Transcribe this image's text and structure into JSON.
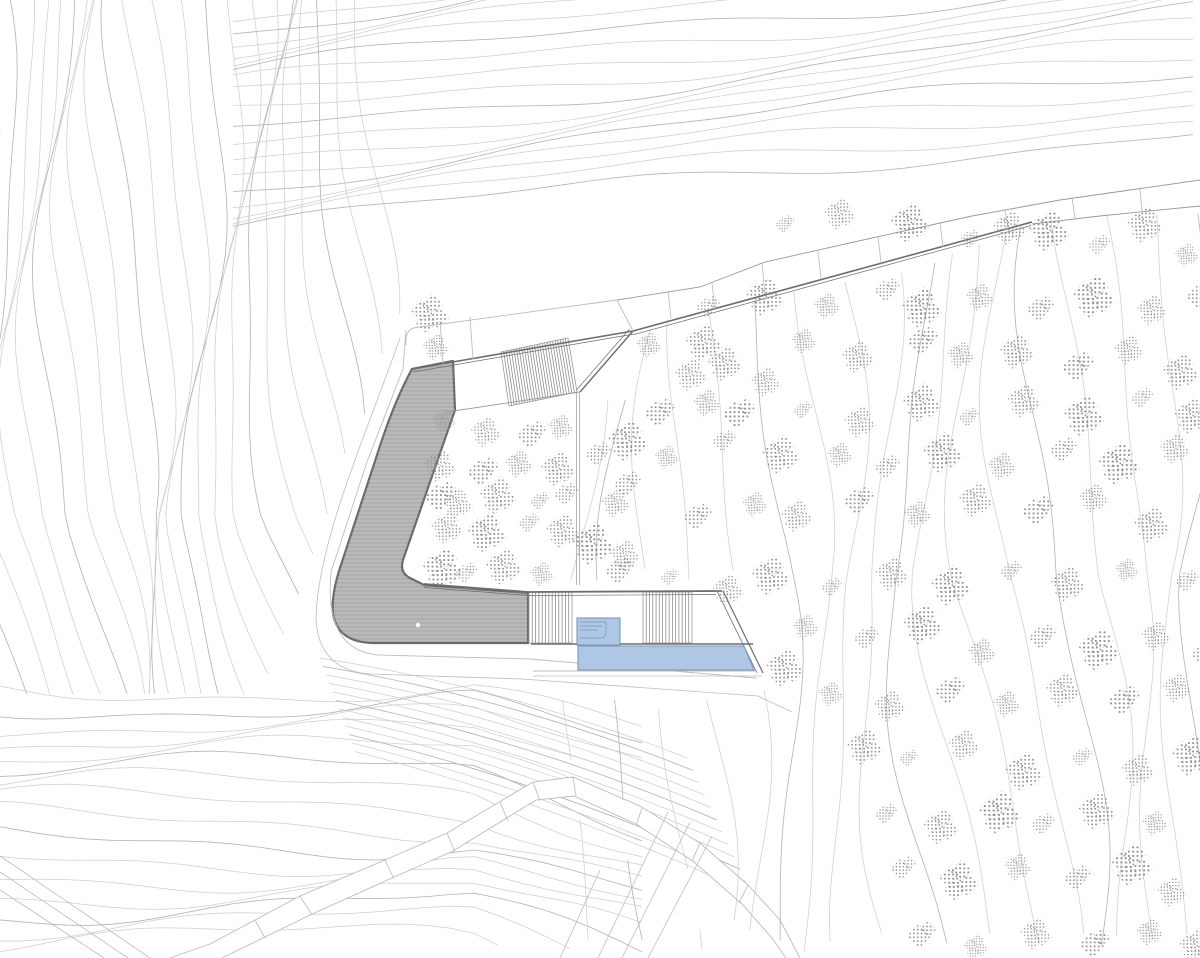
{
  "colors": {
    "paper": "#ffffff",
    "contour": "#cfcfcf",
    "contour_dark": "#b5b5b5",
    "outline": "#6d6d6d",
    "outline_mid": "#9a9a9a",
    "outline_soft": "#bcbcbc",
    "roof": "#b3b3b3",
    "roof_edge": "#6a6a6a",
    "stair_line": "#8f8f8f",
    "tree_dot": "#8f8f8f",
    "pool_fill": "#adc7e4",
    "pool_edge": "#7d97b5"
  },
  "site": {
    "contour_fields": {
      "left": 24,
      "top": 18,
      "right": 18,
      "bottom": 16,
      "bundle": 12
    },
    "white_shapes": [
      "M413,328 L617,300 L633,331 L412,369 Z",
      "M617,300 L700,287 L765,262 L872,238 L972,216 L1060,200 L1130,190 L1200,180 L1200,206 L1100,216 L1032,224 L957,243 L845,272 L735,302 L633,331 Z",
      "M452,412 L578,392 L578,586 L424,584 Q404,581 403,559 Z",
      "M528,591 L723,591 L765,677 L530,677 Z",
      "M170,958 L210,944 L300,896 L385,860 L447,833 L533,782 L573,777 L640,806 L700,843 L748,885 L780,920 L800,958 L786,958 L772,938 L742,904 L694,862 L636,824 L574,796 L536,800 L453,851 L392,878 L310,915 L222,958 Z"
    ],
    "roof_path": "M412,369 L453,361 L455,410 L404,557 Q398,572 410,578 L424,585 L528,593 L528,643 L375,643 Q338,643 333,614 Q331,596 340,568 L378,452 Q394,402 412,369 Z",
    "roof_drain": [
      418,
      625
    ],
    "linework": [
      {
        "d": "M413,328 L617,300",
        "c": "soft",
        "w": 0.9
      },
      {
        "d": "M406,345 Q405,330 414,328",
        "c": "soft",
        "w": 0.9
      },
      {
        "d": "M406,330 L403,369 L367,462 L331,572 Q324,650 378,655 L530,659 L756,678",
        "c": "soft",
        "w": 0.9
      },
      {
        "d": "M400,338 C368,430 318,540 316,618 Q318,670 370,674 L522,679 L758,696 L792,712",
        "c": "soft",
        "w": 0.8
      },
      {
        "d": "M412,369 L633,331",
        "c": "dark",
        "w": 1.6
      },
      {
        "d": "M413,372 L634,334",
        "c": "dark",
        "w": 0.7
      },
      {
        "d": "M633,331 L1032,222",
        "c": "dark",
        "w": 1.6
      },
      {
        "d": "M634,334.5 L1031,225.5",
        "c": "dark",
        "w": 0.7
      },
      {
        "d": "M633,331 L580,392",
        "c": "dark",
        "w": 1.4
      },
      {
        "d": "M629.5,329 L576.5,390",
        "c": "dark",
        "w": 0.7
      },
      {
        "d": "M447,412 L580,392",
        "c": "mid",
        "w": 0.9
      },
      {
        "d": "M576.5,393 L576.5,585",
        "c": "mid",
        "w": 0.7
      },
      {
        "d": "M579.5,393 L579.5,585",
        "c": "mid",
        "w": 0.7
      },
      {
        "d": "M424,584 L528,592 L722,591",
        "c": "dark",
        "w": 1.8
      },
      {
        "d": "M424,587.5 L528,595.5 L716,594.5",
        "c": "dark",
        "w": 0.7
      },
      {
        "d": "M723,591 L763,673",
        "c": "dark",
        "w": 1.2
      },
      {
        "d": "M717,591 L757,673",
        "c": "dark",
        "w": 0.8
      },
      {
        "d": "M531,644 L753,644",
        "c": "dark",
        "w": 1.6
      },
      {
        "d": "M533,671 L757,671",
        "c": "soft",
        "w": 0.9
      },
      {
        "d": "M533,676 L762,676",
        "c": "soft",
        "w": 0.8
      },
      {
        "d": "M617,300 L700,287 L765,262 L872,238 L972,216 L1060,200 L1130,190 L1200,180",
        "c": "mid",
        "w": 0.9
      },
      {
        "d": "M1032,224 L1100,216 L1200,206",
        "c": "mid",
        "w": 0.9
      },
      {
        "d": "M170,958 L210,944 L300,896 L385,860 L447,833 L533,782 L573,777 L640,806 L700,843 L748,885 L780,920 L800,958",
        "c": "soft",
        "w": 0.9
      },
      {
        "d": "M222,958 L310,915 L392,878 L453,851 L536,800 L574,796 L636,824 L694,862 L742,904 L772,938 L786,958",
        "c": "soft",
        "w": 0.9
      },
      {
        "d": "M598,958 L668,812",
        "c": "soft",
        "w": 0.8
      },
      {
        "d": "M622,958 L690,822",
        "c": "soft",
        "w": 0.8
      },
      {
        "d": "M648,958 L712,836",
        "c": "soft",
        "w": 0.8
      },
      {
        "d": "M560,958 L600,870",
        "c": "soft",
        "w": 0.8
      },
      {
        "d": "M0,856 L150,958",
        "c": "soft",
        "w": 0.8
      },
      {
        "d": "M0,872 L128,958",
        "c": "soft",
        "w": 0.8
      },
      {
        "d": "M0,890 L104,958",
        "c": "soft",
        "w": 0.8
      }
    ],
    "divisions": [
      [
        440,
        321,
        443,
        364
      ],
      [
        470,
        317,
        473,
        359
      ],
      [
        617,
        300,
        633,
        331
      ],
      [
        668,
        291,
        671,
        318
      ],
      [
        712,
        283,
        715,
        309
      ],
      [
        762,
        263,
        765,
        294
      ],
      [
        818,
        251,
        821,
        279
      ],
      [
        878,
        236,
        881,
        263
      ],
      [
        940,
        222,
        943,
        247
      ],
      [
        1005,
        209,
        1008,
        230
      ],
      [
        1072,
        197,
        1075,
        219
      ],
      [
        1140,
        189,
        1142,
        212
      ],
      [
        300,
        896,
        312,
        915
      ],
      [
        385,
        860,
        394,
        879
      ],
      [
        447,
        833,
        455,
        852
      ],
      [
        500,
        802,
        508,
        821
      ],
      [
        533,
        782,
        540,
        801
      ],
      [
        573,
        777,
        576,
        796
      ],
      [
        642,
        808,
        636,
        826
      ],
      [
        700,
        843,
        692,
        861
      ],
      [
        748,
        885,
        739,
        903
      ],
      [
        255,
        920,
        265,
        938
      ]
    ],
    "stairs": [
      {
        "corners": [
          [
            501,
            352
          ],
          [
            568,
            338
          ],
          [
            577,
            392
          ],
          [
            509,
            406
          ]
        ],
        "treads": 26
      },
      {
        "corners": [
          [
            529,
            592
          ],
          [
            572,
            592
          ],
          [
            572,
            643
          ],
          [
            529,
            643
          ]
        ],
        "treads": 13
      },
      {
        "corners": [
          [
            643,
            592
          ],
          [
            692,
            592
          ],
          [
            692,
            643
          ],
          [
            643,
            643
          ]
        ],
        "treads": 15
      }
    ],
    "pool": {
      "body": [
        [
          578,
          646
        ],
        [
          744,
          646
        ],
        [
          754,
          670
        ],
        [
          578,
          670
        ]
      ],
      "spa": [
        577,
        618,
        43,
        27
      ],
      "spa_steps": "M580,622 H606 M580,626 H602 M580,630 H598 M606,622 V632 Q606,638 600,638 H580"
    },
    "trees": [
      [
        452,
        428
      ],
      [
        492,
        425
      ],
      [
        533,
        430
      ],
      [
        563,
        422
      ],
      [
        440,
        462
      ],
      [
        478,
        470
      ],
      [
        515,
        462
      ],
      [
        552,
        468
      ],
      [
        430,
        498
      ],
      [
        465,
        505
      ],
      [
        503,
        498
      ],
      [
        541,
        505
      ],
      [
        448,
        532
      ],
      [
        486,
        538
      ],
      [
        524,
        530
      ],
      [
        558,
        538
      ],
      [
        436,
        562
      ],
      [
        472,
        568
      ],
      [
        510,
        562
      ],
      [
        546,
        570
      ],
      [
        566,
        492
      ],
      [
        430,
        312
      ],
      [
        434,
        346
      ],
      [
        592,
        455
      ],
      [
        622,
        442
      ],
      [
        608,
        505
      ],
      [
        632,
        488
      ],
      [
        598,
        548
      ],
      [
        628,
        560
      ],
      [
        618,
        578
      ],
      [
        648,
        352
      ],
      [
        688,
        368
      ],
      [
        652,
        408
      ],
      [
        700,
        398
      ],
      [
        733,
        360
      ],
      [
        742,
        412
      ],
      [
        770,
        380
      ],
      [
        706,
        342
      ],
      [
        783,
        225
      ],
      [
        838,
        215
      ],
      [
        906,
        225
      ],
      [
        962,
        243
      ],
      [
        1002,
        232
      ],
      [
        1056,
        236
      ],
      [
        1102,
        252
      ],
      [
        1148,
        232
      ],
      [
        1188,
        248
      ],
      [
        705,
        302
      ],
      [
        762,
        292
      ],
      [
        822,
        302
      ],
      [
        878,
        288
      ],
      [
        930,
        306
      ],
      [
        986,
        296
      ],
      [
        1042,
        310
      ],
      [
        1096,
        298
      ],
      [
        1152,
        312
      ],
      [
        1196,
        300
      ],
      [
        800,
        345
      ],
      [
        852,
        362
      ],
      [
        912,
        348
      ],
      [
        968,
        362
      ],
      [
        1022,
        345
      ],
      [
        1078,
        362
      ],
      [
        1130,
        345
      ],
      [
        1180,
        368
      ],
      [
        798,
        408
      ],
      [
        855,
        420
      ],
      [
        915,
        402
      ],
      [
        975,
        418
      ],
      [
        1030,
        402
      ],
      [
        1088,
        418
      ],
      [
        1142,
        402
      ],
      [
        1192,
        420
      ],
      [
        665,
        462
      ],
      [
        718,
        448
      ],
      [
        775,
        462
      ],
      [
        832,
        448
      ],
      [
        892,
        462
      ],
      [
        948,
        448
      ],
      [
        1005,
        462
      ],
      [
        1062,
        448
      ],
      [
        1118,
        462
      ],
      [
        1172,
        448
      ],
      [
        690,
        518
      ],
      [
        748,
        505
      ],
      [
        805,
        518
      ],
      [
        862,
        505
      ],
      [
        922,
        518
      ],
      [
        978,
        505
      ],
      [
        1035,
        518
      ],
      [
        1092,
        505
      ],
      [
        1148,
        518
      ],
      [
        662,
        572
      ],
      [
        720,
        585
      ],
      [
        778,
        572
      ],
      [
        835,
        585
      ],
      [
        895,
        572
      ],
      [
        952,
        585
      ],
      [
        1008,
        572
      ],
      [
        1065,
        585
      ],
      [
        1122,
        572
      ],
      [
        1178,
        585
      ],
      [
        793,
        672
      ],
      [
        812,
        632
      ],
      [
        868,
        645
      ],
      [
        925,
        632
      ],
      [
        982,
        645
      ],
      [
        1038,
        632
      ],
      [
        1095,
        645
      ],
      [
        1150,
        632
      ],
      [
        1195,
        652
      ],
      [
        838,
        692
      ],
      [
        895,
        705
      ],
      [
        950,
        692
      ],
      [
        1008,
        705
      ],
      [
        1062,
        692
      ],
      [
        1118,
        705
      ],
      [
        1172,
        692
      ],
      [
        858,
        752
      ],
      [
        915,
        765
      ],
      [
        970,
        752
      ],
      [
        1028,
        765
      ],
      [
        1082,
        752
      ],
      [
        1138,
        765
      ],
      [
        1190,
        752
      ],
      [
        880,
        812
      ],
      [
        935,
        825
      ],
      [
        992,
        812
      ],
      [
        1048,
        825
      ],
      [
        1102,
        812
      ],
      [
        1158,
        825
      ],
      [
        902,
        872
      ],
      [
        958,
        885
      ],
      [
        1015,
        872
      ],
      [
        1070,
        885
      ],
      [
        1125,
        872
      ],
      [
        1180,
        885
      ],
      [
        925,
        930
      ],
      [
        980,
        942
      ],
      [
        1038,
        930
      ],
      [
        1092,
        942
      ],
      [
        1148,
        930
      ],
      [
        1192,
        945
      ]
    ]
  }
}
